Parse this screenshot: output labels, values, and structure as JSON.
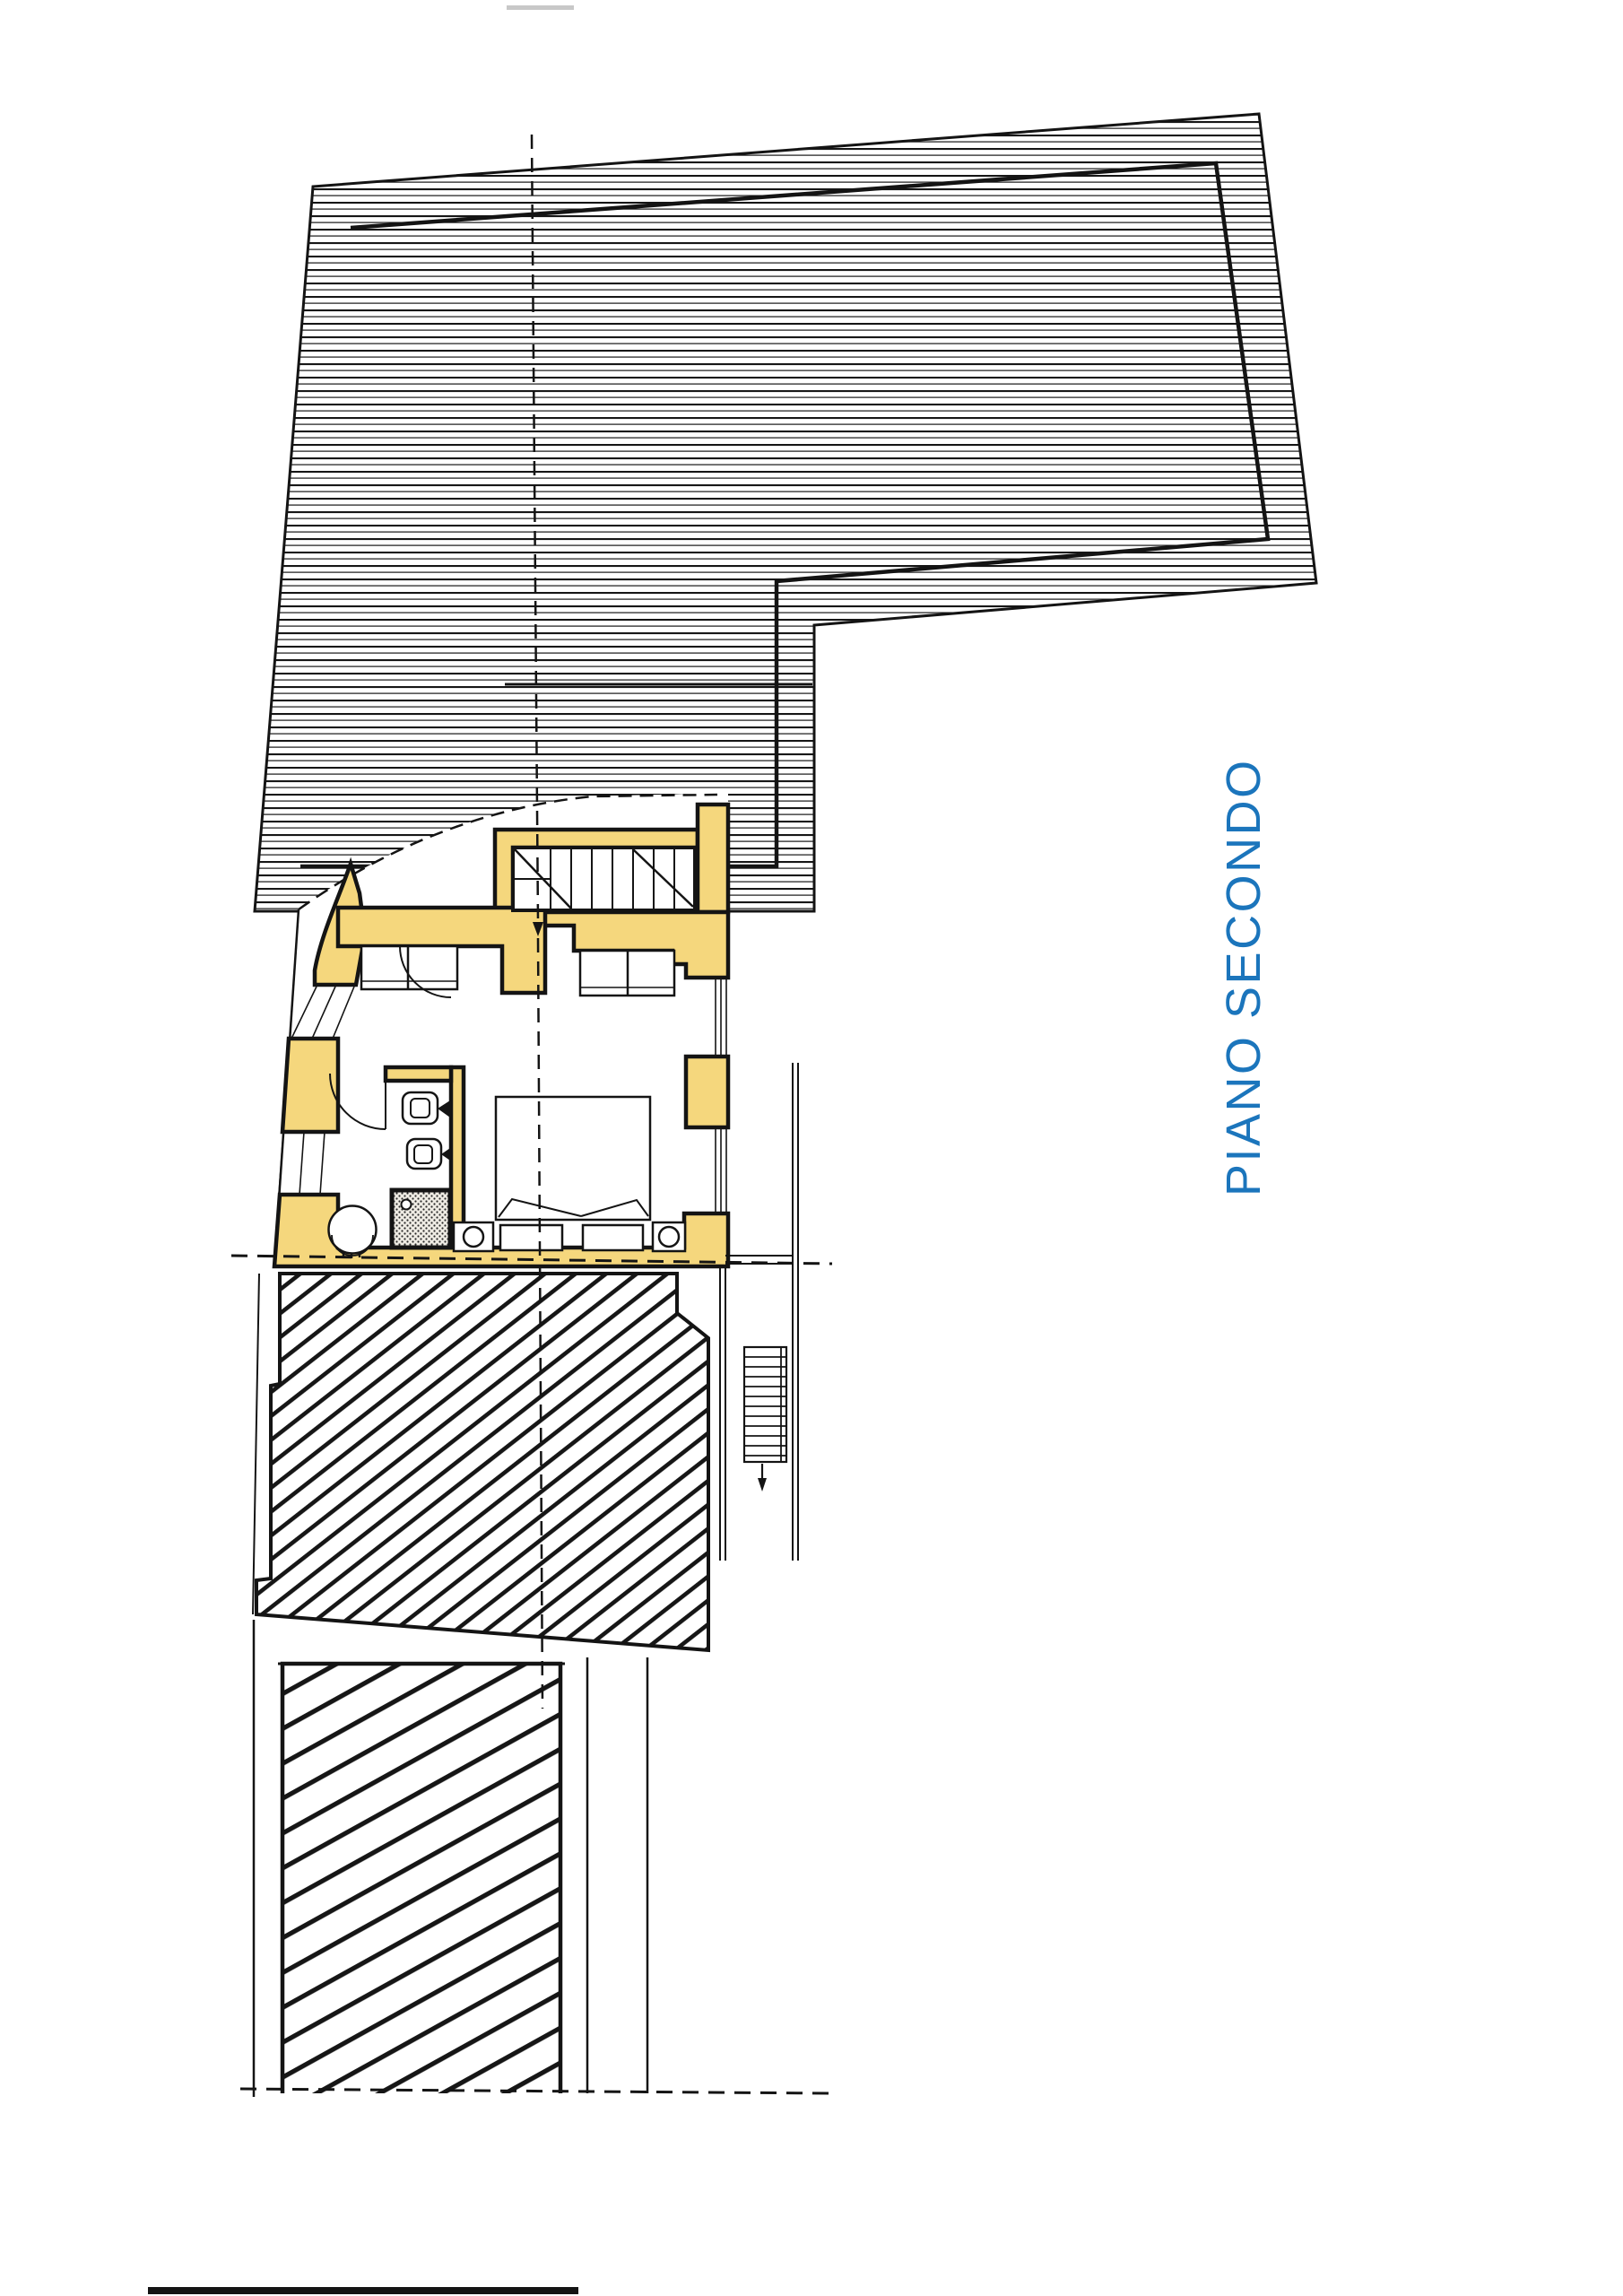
{
  "drawing": {
    "floor_label": "PIANO SECONDO",
    "type_note": "architectural floor plan, scanned sheet"
  },
  "colors": {
    "wall_yellow": "#f5d77d",
    "line_black": "#141414",
    "label_blue": "#1b75bc",
    "paper_white": "#ffffff"
  }
}
